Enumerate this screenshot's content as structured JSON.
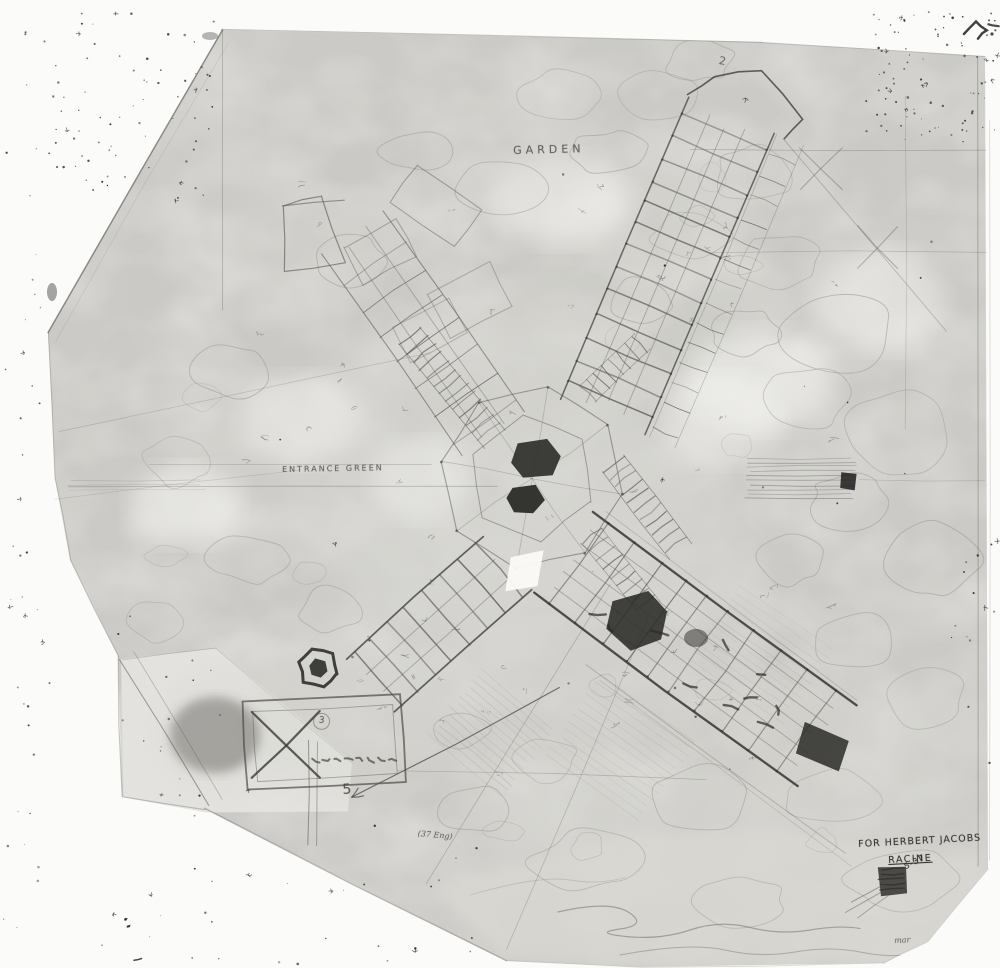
{
  "palette": {
    "background": "#fbfbfa",
    "paper": "#edece8",
    "paper_fragment": "#e4e3df",
    "wash": "#d8d7d2",
    "ink_dark": "#2b2b28",
    "ink_mid": "#55534d",
    "ink_light": "#8a8983",
    "contour": "#9b9a94",
    "speck": "#1e1e1c",
    "erase": "#f8f7f4"
  },
  "annotations": {
    "garden": "GARDEN",
    "entrance_green": "ENTRANCE GREEN",
    "wing_number": "2",
    "station_number": "5",
    "terrace_number": "3",
    "survey_note": "(37 Eng)",
    "corner_note": "mar"
  },
  "title_block": {
    "dedication_line": "FOR HERBERT JACOBS",
    "location_line": "RACINE",
    "date_mark": "5-37"
  }
}
